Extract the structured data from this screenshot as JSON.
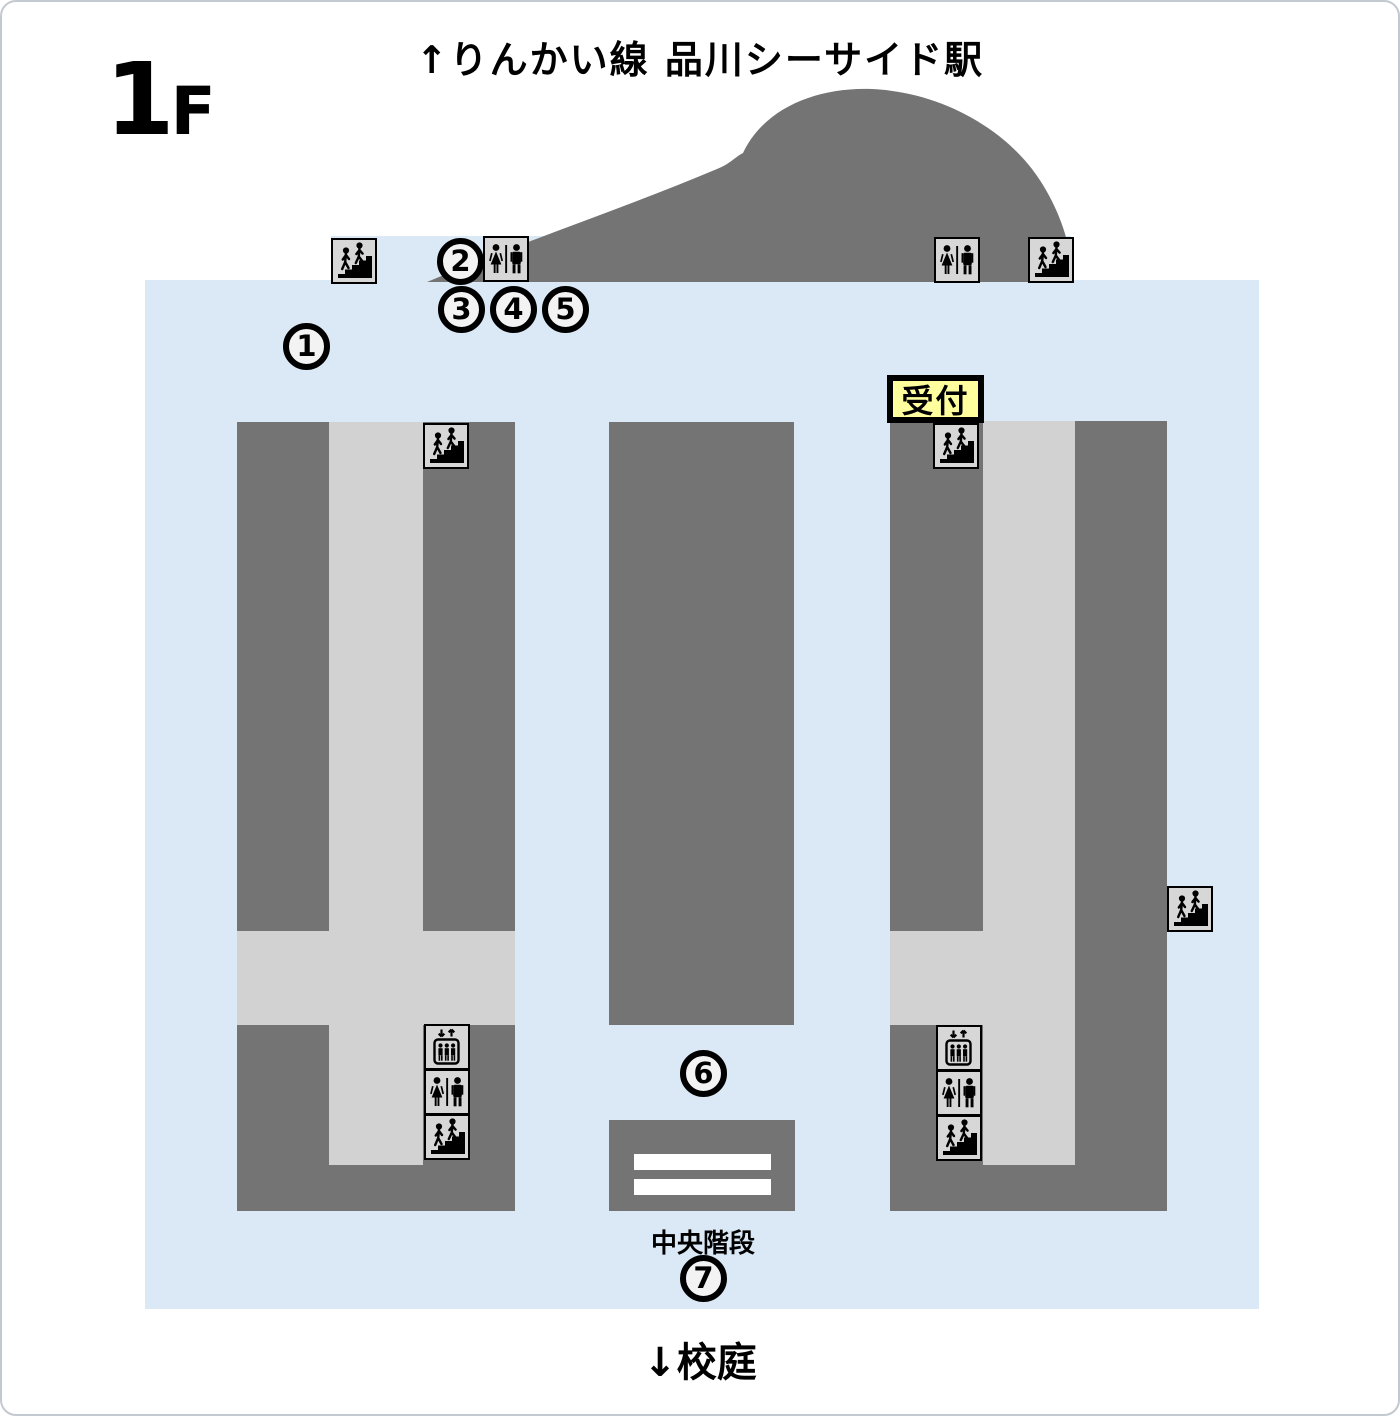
{
  "page": {
    "floor_number": "1",
    "floor_suffix": "F",
    "top_direction_label": "↑りんかい線 品川シーサイド駅",
    "bottom_direction_label": "↓校庭",
    "central_stairs_label": "中央階段",
    "reception_label": "受付"
  },
  "markers": [
    {
      "label": "1"
    },
    {
      "label": "2"
    },
    {
      "label": "3"
    },
    {
      "label": "4"
    },
    {
      "label": "5"
    },
    {
      "label": "6"
    },
    {
      "label": "7"
    }
  ],
  "icons": {
    "stairs": "stairs-icon",
    "restroom": "restroom-icon",
    "elevator": "elevator-icon"
  },
  "colors": {
    "map_background": "#dbe9f6",
    "building": "#747474",
    "corridor": "#d2d2d2",
    "icon_box_background": "#d7d7d7",
    "reception_background": "#ffff9e",
    "marker_background": "#f3f3f3",
    "outline": "#000000"
  }
}
